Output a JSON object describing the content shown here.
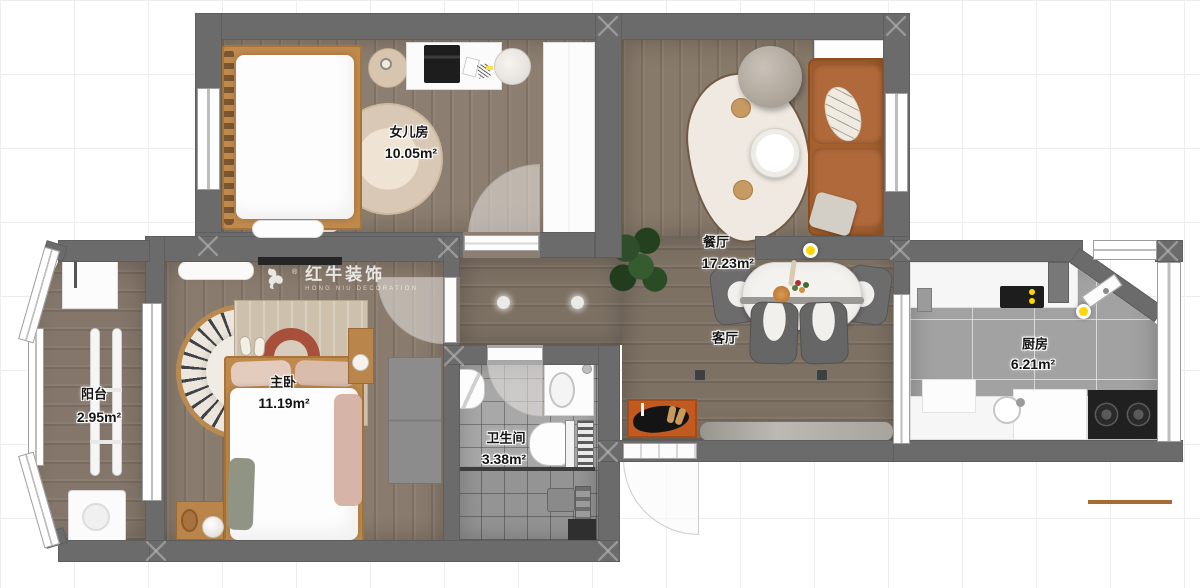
{
  "watermark": {
    "title": "红牛装饰",
    "subtitle": "HONG NIU DECORATION",
    "registered": "®"
  },
  "rooms": [
    {
      "id": "daughter-room",
      "name": "女儿房",
      "area": "10.05m²"
    },
    {
      "id": "dining-room",
      "name": "餐厅",
      "area": "17.23m²"
    },
    {
      "id": "living-room",
      "name": "客厅",
      "area": ""
    },
    {
      "id": "balcony",
      "name": "阳台",
      "area": "2.95m²"
    },
    {
      "id": "master-bedroom",
      "name": "主卧",
      "area": "11.19m²"
    },
    {
      "id": "bathroom",
      "name": "卫生间",
      "area": "3.38m²"
    },
    {
      "id": "kitchen",
      "name": "厨房",
      "area": "6.21m²"
    }
  ],
  "palette": {
    "wall": "#6b6b6b",
    "wood_floor": "#867969",
    "living_floor": "#7d7164",
    "bath_tile": "#a8a8a8",
    "kitchen_tile": "#a2a2a2",
    "sofa": "#a5602d",
    "bed_frame": "#c08a4e",
    "entry_mat": "#c05a20",
    "ceiling_light": "#ffd600"
  }
}
